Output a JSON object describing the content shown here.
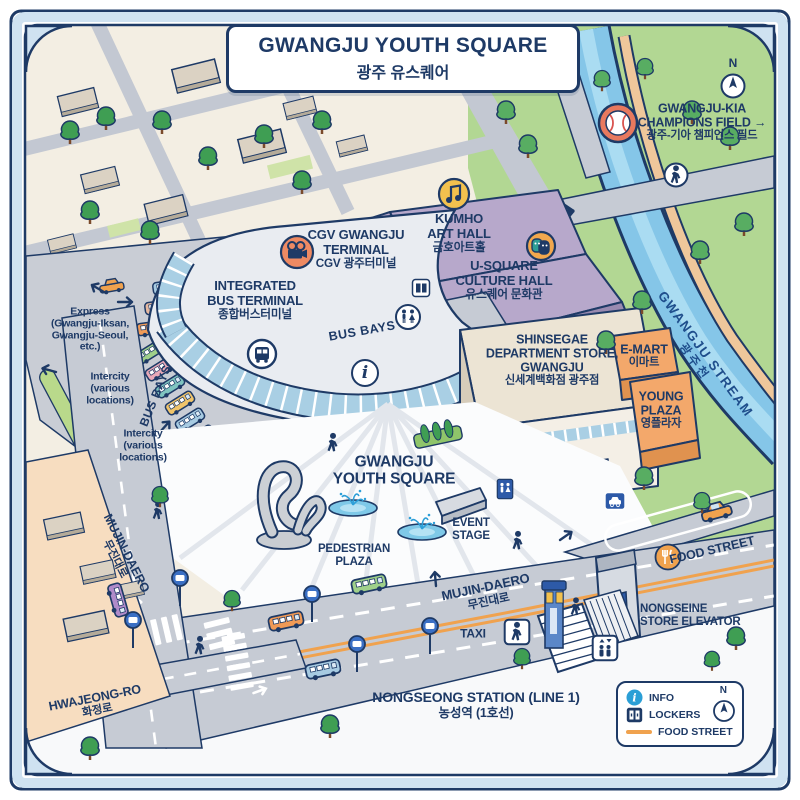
{
  "palette": {
    "navy": "#1e3a66",
    "cream": "#f3eee3",
    "road": "#c6cbd4",
    "park": "#b2d793",
    "stream_blue": "#85c6e8",
    "hall_purple": "#b7a8cb",
    "orange_building": "#f3a86b",
    "food_orange": "#f0a24e",
    "glass_blue": "#a9cfe4",
    "legend_info_blue": "#2b9fd6"
  },
  "title": {
    "en": "GWANGJU YOUTH SQUARE",
    "ko": "광주 유스퀘어"
  },
  "compass": {
    "north": "N"
  },
  "landmarks": {
    "champions_field": {
      "line1": "GWANGJU-KIA",
      "line2": "CHAMPIONS FIELD →",
      "ko": "광주-기아 챔피언스 필드"
    },
    "stream": {
      "en": "GWANGJU STREAM",
      "ko": "광주천"
    },
    "cgv": {
      "line1": "CGV GWANGJU",
      "line2": "TERMINAL",
      "ko": "CGV 광주터미널"
    },
    "kumho": {
      "line1": "KUMHO",
      "line2": "ART HALL",
      "ko": "금호아트홀"
    },
    "usquare_hall": {
      "line1": "U-SQUARE",
      "line2": "CULTURE HALL",
      "ko": "유스퀘어 문화관"
    },
    "terminal": {
      "line1": "INTEGRATED",
      "line2": "BUS TERMINAL",
      "ko": "종합버스터미널"
    },
    "shinsegae": {
      "line1": "SHINSEGAE",
      "line2": "DEPARTMENT STORE,",
      "line3": "GWANGJU",
      "ko": "신세계백화점 광주점"
    },
    "emart": {
      "en": "E-MART",
      "ko": "이마트"
    },
    "young_plaza": {
      "line1": "YOUNG",
      "line2": "PLAZA",
      "ko": "영플라자"
    },
    "youth_square": {
      "line1": "GWANGJU",
      "line2": "YOUTH SQUARE"
    },
    "pedestrian_plaza": {
      "line1": "PEDESTRIAN",
      "line2": "PLAZA"
    },
    "event_stage": {
      "line1": "EVENT",
      "line2": "STAGE"
    },
    "station": {
      "en": "NONGSEONG STATION (LINE 1)",
      "ko": "농성역 (1호선)"
    },
    "store_elevator": {
      "line1": "NONGSEINE",
      "line2": "STORE ELEVATOR"
    },
    "taxi": "TAXI"
  },
  "roads": {
    "mujin_daero": {
      "en": "MUJIN-DAERO",
      "ko": "무진대로"
    },
    "mujin_daero_left": {
      "en": "MUJIN-DAERO",
      "ko": "무진대로"
    },
    "hwajeong_ro": {
      "en": "HWAJEONG-RO",
      "ko": "화정로"
    },
    "food_street": "FOOD STREET"
  },
  "bus_area": {
    "bays_left": "BUS BAYS",
    "bays_center": "BUS BAYS",
    "express": {
      "line1": "Express",
      "line2": "(Gwangju-Iksan,",
      "line3": "Gwangju-Seoul,",
      "line4": "etc.)"
    },
    "intercity_1": {
      "line1": "Intercity",
      "line2": "(various",
      "line3": "locations)"
    },
    "intercity_2": {
      "line1": "Intercity",
      "line2": "(various",
      "line3": "locations)"
    }
  },
  "legend": {
    "info": "INFO",
    "lockers": "LOCKERS",
    "food_street": "FOOD STREET",
    "north": "N"
  }
}
